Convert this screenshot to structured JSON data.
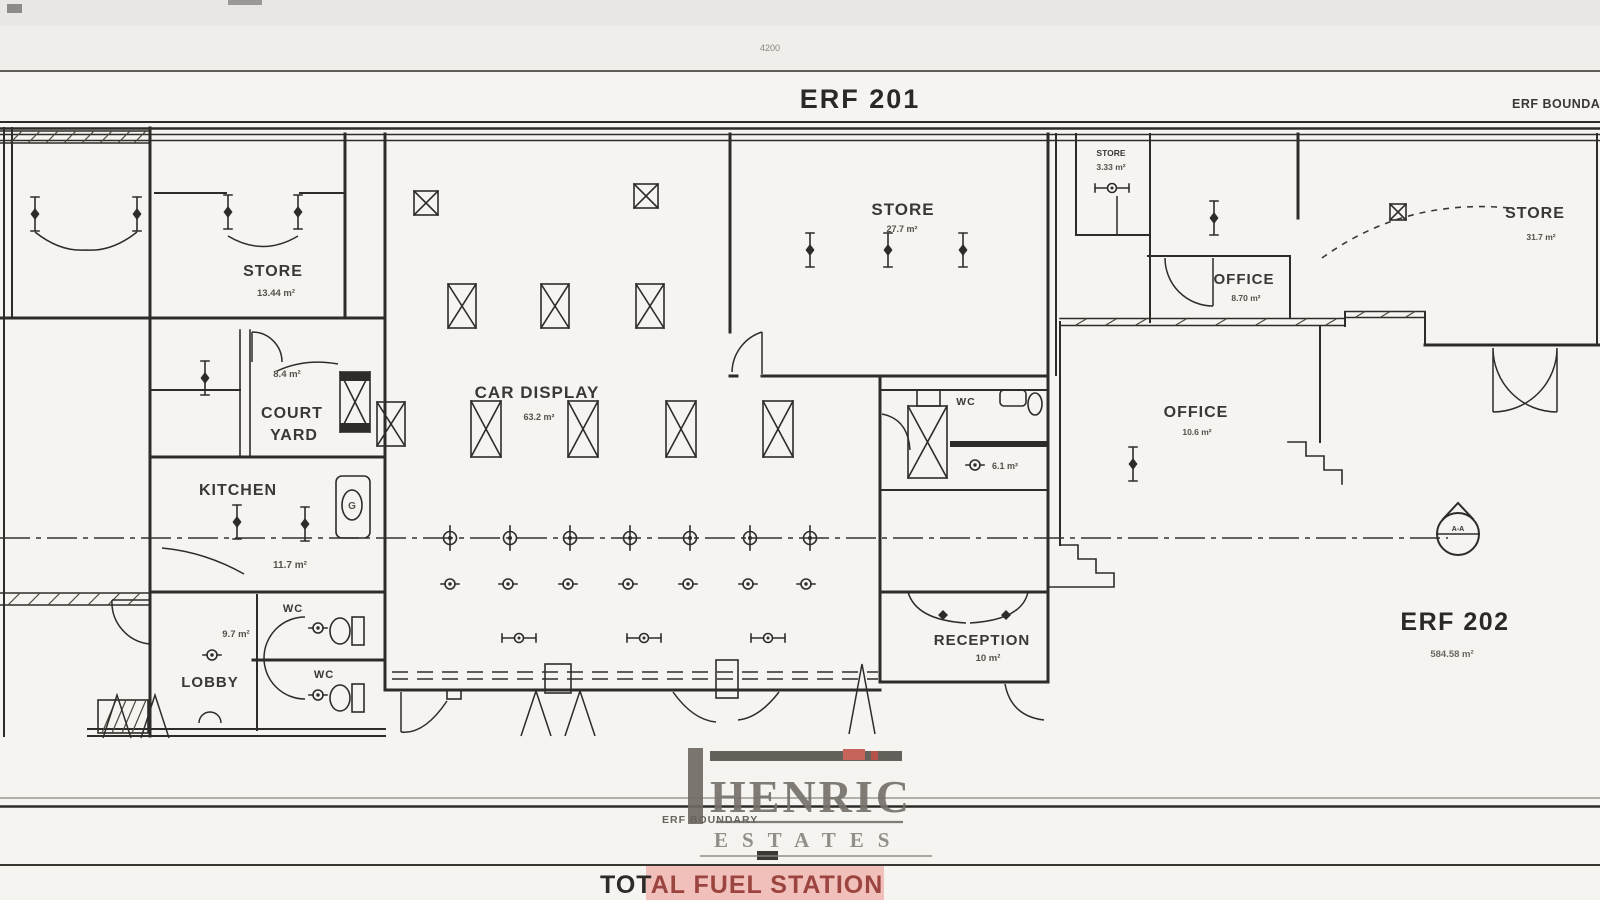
{
  "site": {
    "erf201_label": "ERF 201",
    "erf_boundary_top_right": "ERF BOUNDARY",
    "dimension_top": "4200",
    "erf202": {
      "label": "ERF 202",
      "area": "584.58 m²"
    },
    "section_marker": "A-A"
  },
  "rooms": {
    "store_left": {
      "name": "STORE",
      "area": "13.44 m²"
    },
    "courtyard": {
      "name_line1": "COURT",
      "name_line2": "YARD",
      "area": "8.4 m²"
    },
    "kitchen": {
      "name": "KITCHEN",
      "area": "11.7 m²"
    },
    "lobby": {
      "name": "LOBBY",
      "area": "9.7 m²"
    },
    "wc_top": {
      "name": "WC"
    },
    "wc_bottom": {
      "name": "WC"
    },
    "car_display": {
      "name": "CAR DISPLAY",
      "area": "63.2 m²"
    },
    "store_center": {
      "name": "STORE",
      "area": "27.7 m²"
    },
    "store_small": {
      "name": "STORE",
      "area": "3.33 m²"
    },
    "office_small": {
      "name": "OFFICE",
      "area": "8.70 m²"
    },
    "office_large": {
      "name": "OFFICE",
      "area": "10.6 m²"
    },
    "wc_center": {
      "name": "WC",
      "area": "6.1 m²"
    },
    "reception": {
      "name": "RECEPTION",
      "area": "10 m²"
    },
    "store_right": {
      "name": "STORE",
      "area": "31.7 m²"
    },
    "appliance_g": {
      "label": "G"
    }
  },
  "watermark": {
    "line1": "HENRIC",
    "line2": "ESTATES"
  },
  "footer": {
    "erf_boundary": "ERF BOUNDARY",
    "title_black": "TOT",
    "title_red": "AL FUEL STATION"
  },
  "colors": {
    "ink": "#2e2c29",
    "logo_gray": "#76716b",
    "accent_red": "#c2574f",
    "highlight_pink": "#f2c0ba"
  }
}
